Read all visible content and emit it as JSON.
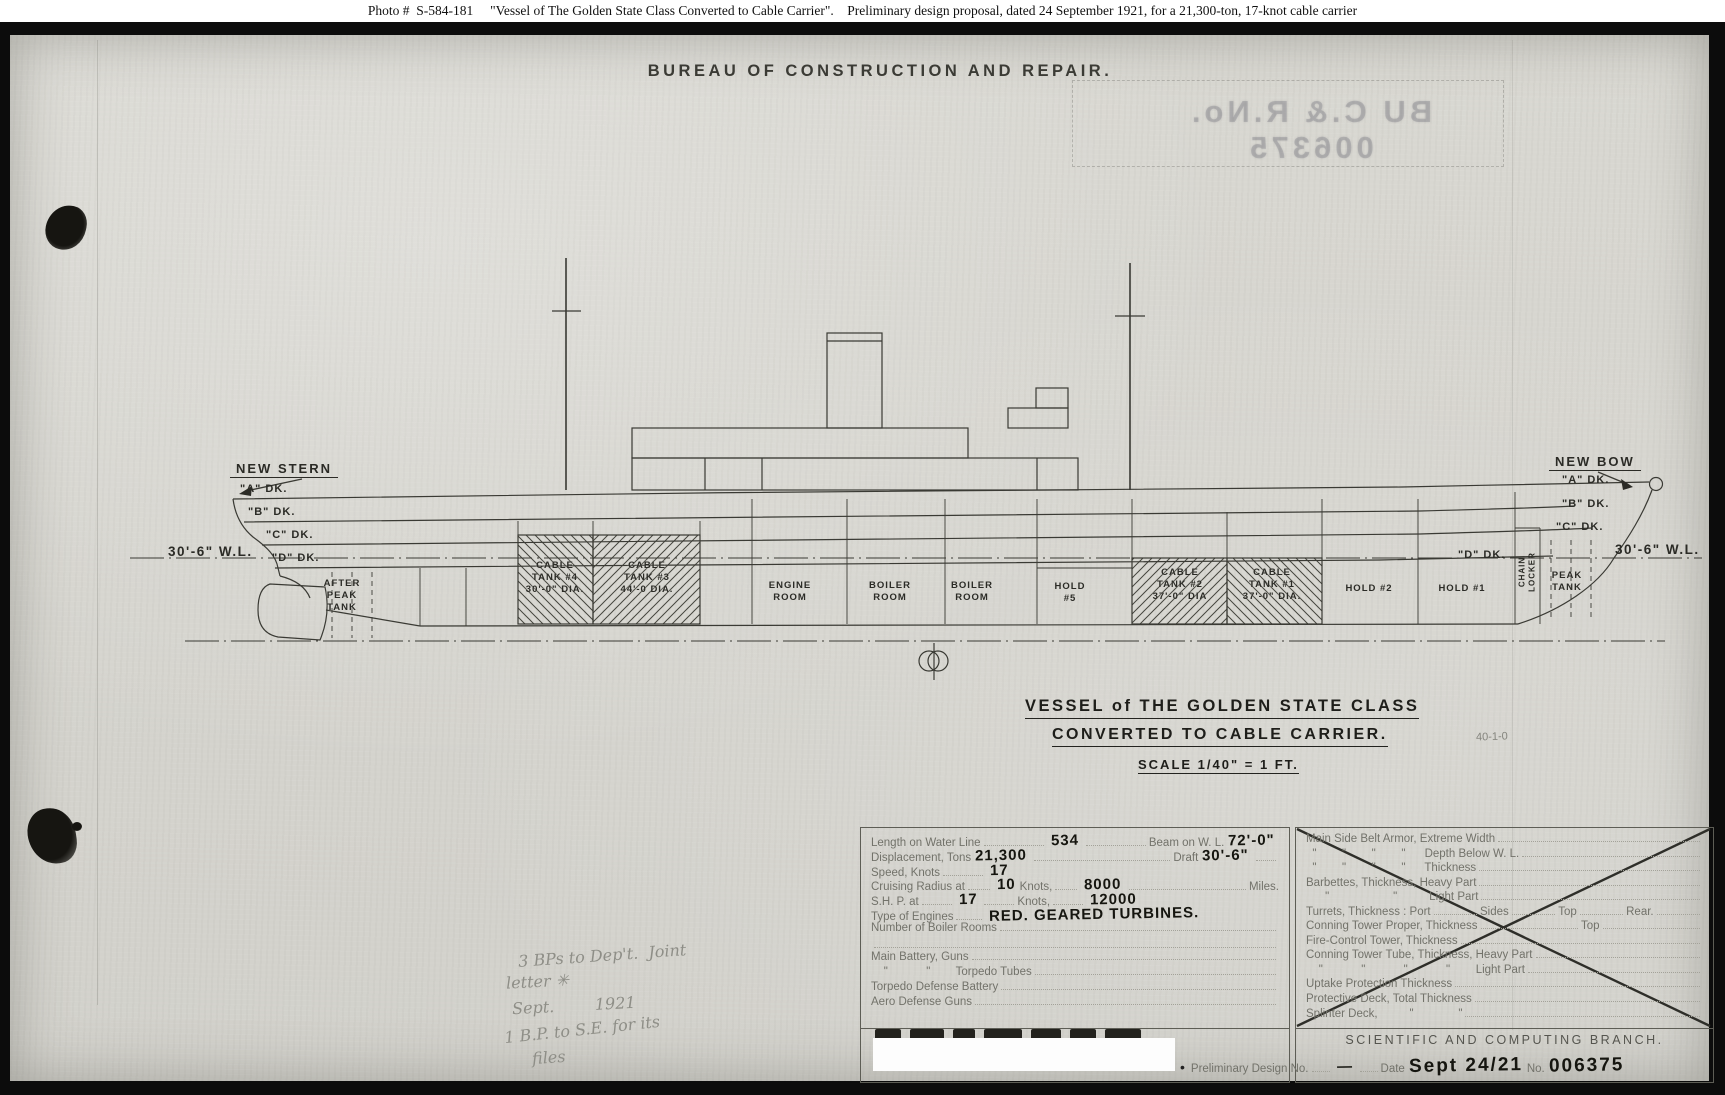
{
  "caption": "Photo #  S-584-181     \"Vessel of The Golden State Class Converted to Cable Carrier\".    Preliminary design proposal, dated 24 September 1921, for a 21,300-ton, 17-knot cable carrier",
  "header": {
    "bureau_title": "BUREAU  OF  CONSTRUCTION  AND  REPAIR.",
    "mirrored_stamp": "BU C.& R.No. 006375"
  },
  "drawing": {
    "stern_label": "NEW STERN",
    "bow_label": "NEW BOW",
    "waterline_left": "30'-6\" W.L.",
    "waterline_right": "30'-6\" W.L.",
    "decks_left": [
      "\"A\" DK.",
      "\"B\" DK.",
      "\"C\" DK.",
      "\"D\" DK."
    ],
    "decks_right": [
      "\"A\" DK.",
      "\"B\" DK.",
      "\"C\" DK.",
      "\"D\" DK."
    ],
    "compartments": {
      "after_peak_tank": "AFTER\nPEAK\nTANK",
      "cable_tank_4": "CABLE\nTANK #4\n30'-0\" DIA.",
      "cable_tank_3": "CABLE\nTANK #3\n44'-0 DIA.",
      "engine_room": "ENGINE\nROOM",
      "boiler_room_aft": "BOILER\nROOM",
      "boiler_room_fwd": "BOILER\nROOM",
      "hold_5": "HOLD\n#5",
      "cable_tank_2": "CABLE\nTANK #2\n37'-0\" DIA",
      "cable_tank_1": "CABLE\nTANK #1\n37'-0\" DIA.",
      "hold_2": "HOLD #2",
      "hold_1": "HOLD #1",
      "chain_locker": "CHAIN\nLOCKER",
      "peak_tank": "PEAK\nTANK"
    }
  },
  "title_block": {
    "line1": "VESSEL of THE GOLDEN STATE CLASS",
    "line2": "CONVERTED TO CABLE CARRIER.",
    "scale": "SCALE 1/40\" = 1 FT.",
    "corner_note": "40-1-0"
  },
  "spec_table": {
    "rows": {
      "r1": {
        "a": "Length on Water Line",
        "av": "534",
        "b": "Beam on W. L.",
        "bv": "72'-0\""
      },
      "r2": {
        "a": "Displacement, Tons",
        "av": "21,300",
        "b": "Draft",
        "bv": "30'-6\""
      },
      "r3": {
        "a": "Speed, Knots",
        "av": "17"
      },
      "r4": {
        "a": "Cruising Radius at",
        "av": "10",
        "b": "Knots,",
        "bv": "8000",
        "c": "Miles."
      },
      "r5": {
        "a": "S.H. P. at",
        "av": "17",
        "b": "Knots,",
        "bv": "12000"
      },
      "r6": {
        "a": "Type of Engines",
        "av": "RED. GEARED TURBINES."
      },
      "r7": {
        "a": "Number of Boiler Rooms"
      },
      "r8": {
        "a": "Main Battery, Guns"
      },
      "r9": {
        "a": "    \"            \"        Torpedo Tubes"
      },
      "r10": {
        "a": "Torpedo Defense Battery"
      },
      "r11": {
        "a": "Aero Defense Guns"
      }
    }
  },
  "armor_table": {
    "rows": {
      "r1": "Main Side Belt Armor, Extreme Width",
      "r2": "  \"        \"        \"        \"      Depth Below W. L.",
      "r3": "  \"        \"        \"        \"      Thickness",
      "r4": "Barbettes, Thickness, Heavy Part",
      "r5": "      \"                    \"          Light Part",
      "r6": {
        "a": "Turrets, Thickness : Port",
        "b": "Sides",
        "c": "Top",
        "d": "Rear."
      },
      "r7": {
        "a": "Conning Tower Proper, Thickness",
        "b": "Top"
      },
      "r8": "Fire-Control Tower, Thickness",
      "r9": "Conning Tower Tube, Thickness, Heavy Part",
      "r10": "    \"            \"            \"            \"        Light Part",
      "r11": "Uptake Protection Thickness",
      "r12": "Protective Deck, Total Thickness",
      "r13": "Splinter Deck,          \"              \""
    }
  },
  "footer": {
    "branch": "SCIENTIFIC AND COMPUTING BRANCH.",
    "bullet": "•",
    "prelim_label": "Preliminary Design No.",
    "prelim_value": "—",
    "date_label": "Date",
    "date_value": "Sept 24/21",
    "no_label": "No.",
    "no_value": "006375"
  },
  "annotations": {
    "pencil_1": "3 BPs to Dep't.  Joint",
    "pencil_2": "letter ✳",
    "pencil_3": "Sept.        1921",
    "pencil_4": "1 B.P. to S.E. for its",
    "pencil_5": "files"
  }
}
